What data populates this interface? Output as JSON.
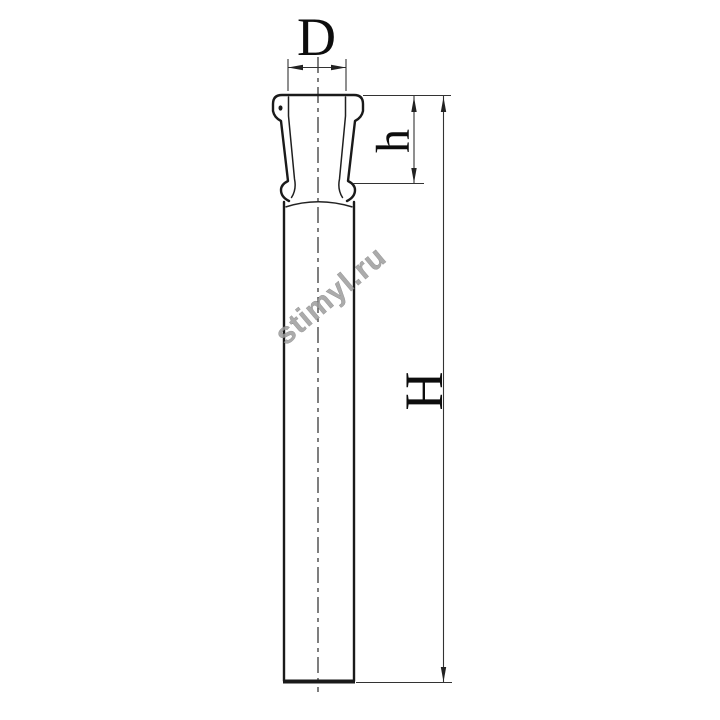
{
  "drawing": {
    "type": "technical-drawing",
    "dimension_labels": {
      "diameter_top": "D",
      "socket_height": "h",
      "overall_height": "H"
    },
    "watermark_text": "stimyl.ru",
    "colors": {
      "background": "#ffffff",
      "outline": "#1a1a1a",
      "dimension_lines": "#333333",
      "labels": "#0d0d0d",
      "watermark": "#9d9d9d"
    }
  }
}
